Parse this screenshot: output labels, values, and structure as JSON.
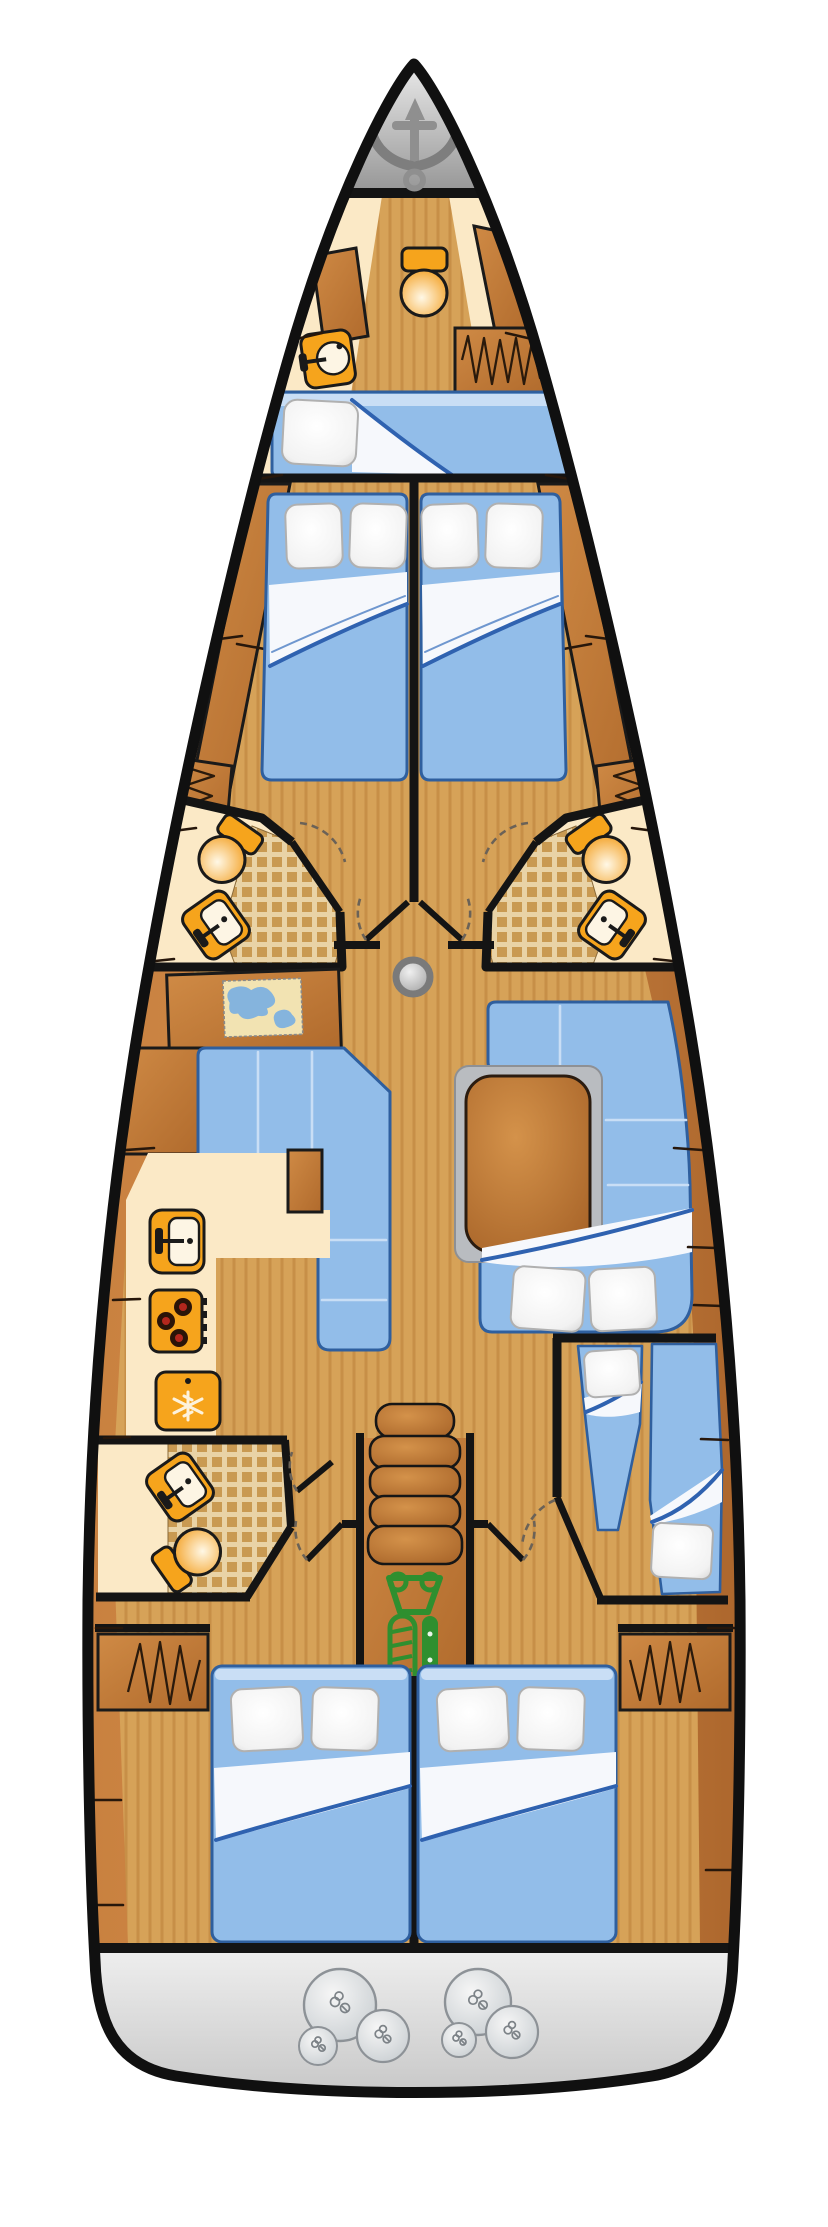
{
  "page": {
    "title": "Sailing yacht interior deck plan",
    "kind": "boat-floor-plan",
    "orientation": {
      "bow": "top",
      "stern": "bottom",
      "view": "top-down"
    }
  },
  "colors": {
    "background": "#ffffff",
    "hull_outline": "#101010",
    "wall": "#141414",
    "wood_base": "#c8803f",
    "wood_dark": "#a9632a",
    "wood_panel": "#cf8a45",
    "wood_panel_dark": "#b06a2c",
    "deck_tan": "#d6a258",
    "deck_stripe": "#b98038",
    "cream": "#fbe9c6",
    "tile": "#c99a52",
    "tile_bg": "#e9d3a6",
    "upholstery": "#92bde9",
    "upholstery_edge": "#2f5f9e",
    "upholstery_light": "#c9def5",
    "sheet_white": "#f6f8fc",
    "fold_line_blue": "#2f62b0",
    "pillow_white": "#fcfcfc",
    "fixture_orange": "#f6a41c",
    "basin_white": "#fdf5e4",
    "anchor_gray": "#8f8f8f",
    "bow_gray_light": "#f2f2f2",
    "bow_gray_dark": "#969696",
    "stern_gray_light": "#eeeeee",
    "stern_gray_dark": "#c0c0c0",
    "engine_green": "#2f8f2f",
    "mast_gray": "#9c9c9c",
    "map_sea": "#85b4dd",
    "map_land": "#f2e3b2",
    "table_wood": "#c9873f"
  },
  "areas": [
    {
      "name": "anchor-locker",
      "position": "bow tip",
      "fixtures": [
        "anchor"
      ]
    },
    {
      "name": "bow-crew-cabin",
      "position": "foredeck",
      "fixtures": [
        "toilet",
        "sink",
        "wardrobe-hanging-locker",
        "single-berth",
        "pillow"
      ]
    },
    {
      "name": "forward-cabin-port",
      "fixtures": [
        "double-bed",
        "2-pillows",
        "hull-shelf",
        "hanging-locker"
      ]
    },
    {
      "name": "forward-cabin-starboard",
      "fixtures": [
        "double-bed",
        "2-pillows",
        "hull-shelf",
        "hanging-locker"
      ]
    },
    {
      "name": "bathroom-forward-port",
      "fixtures": [
        "toilet",
        "sink",
        "shower-tiled-floor",
        "door"
      ]
    },
    {
      "name": "bathroom-forward-starboard",
      "fixtures": [
        "toilet",
        "sink",
        "shower-tiled-floor",
        "door"
      ]
    },
    {
      "name": "corridor-forward",
      "fixtures": [
        "cabin-door-port",
        "cabin-door-starboard",
        "mast"
      ]
    },
    {
      "name": "navigation-station-port",
      "fixtures": [
        "chart-table",
        "sea-chart-map"
      ]
    },
    {
      "name": "salon",
      "fixtures": [
        "l-shaped-sofa-port",
        "u-shaped-sofa-starboard",
        "wooden-table",
        "convertible-berth-2-pillows"
      ]
    },
    {
      "name": "galley-port",
      "fixtures": [
        "sink",
        "stove-3-burners",
        "refrigerator-snowflake"
      ]
    },
    {
      "name": "bathroom-aft-port",
      "fixtures": [
        "sink",
        "toilet",
        "shower-tiled-floor",
        "door"
      ]
    },
    {
      "name": "companionway-center",
      "fixtures": [
        "5-steps",
        "engine-compartment"
      ]
    },
    {
      "name": "skipper-cabin-starboard",
      "fixtures": [
        "single-berth-forward-pillow",
        "single-berth-aft-pillow",
        "door"
      ]
    },
    {
      "name": "aft-cabin-port",
      "fixtures": [
        "double-bed",
        "2-pillows",
        "wardrobe-hanging-locker",
        "door"
      ]
    },
    {
      "name": "aft-cabin-starboard",
      "fixtures": [
        "double-bed",
        "2-pillows",
        "wardrobe-hanging-locker",
        "door"
      ]
    },
    {
      "name": "transom",
      "position": "stern",
      "fixtures": [
        "fender-cluster-port-3",
        "fender-cluster-starboard-3"
      ]
    }
  ],
  "counts": {
    "cabins": 6,
    "berths": 8,
    "bathrooms": 3,
    "toilets": 4,
    "sinks": 5,
    "pillows": 13,
    "fenders": 6,
    "companionway_steps": 5
  }
}
